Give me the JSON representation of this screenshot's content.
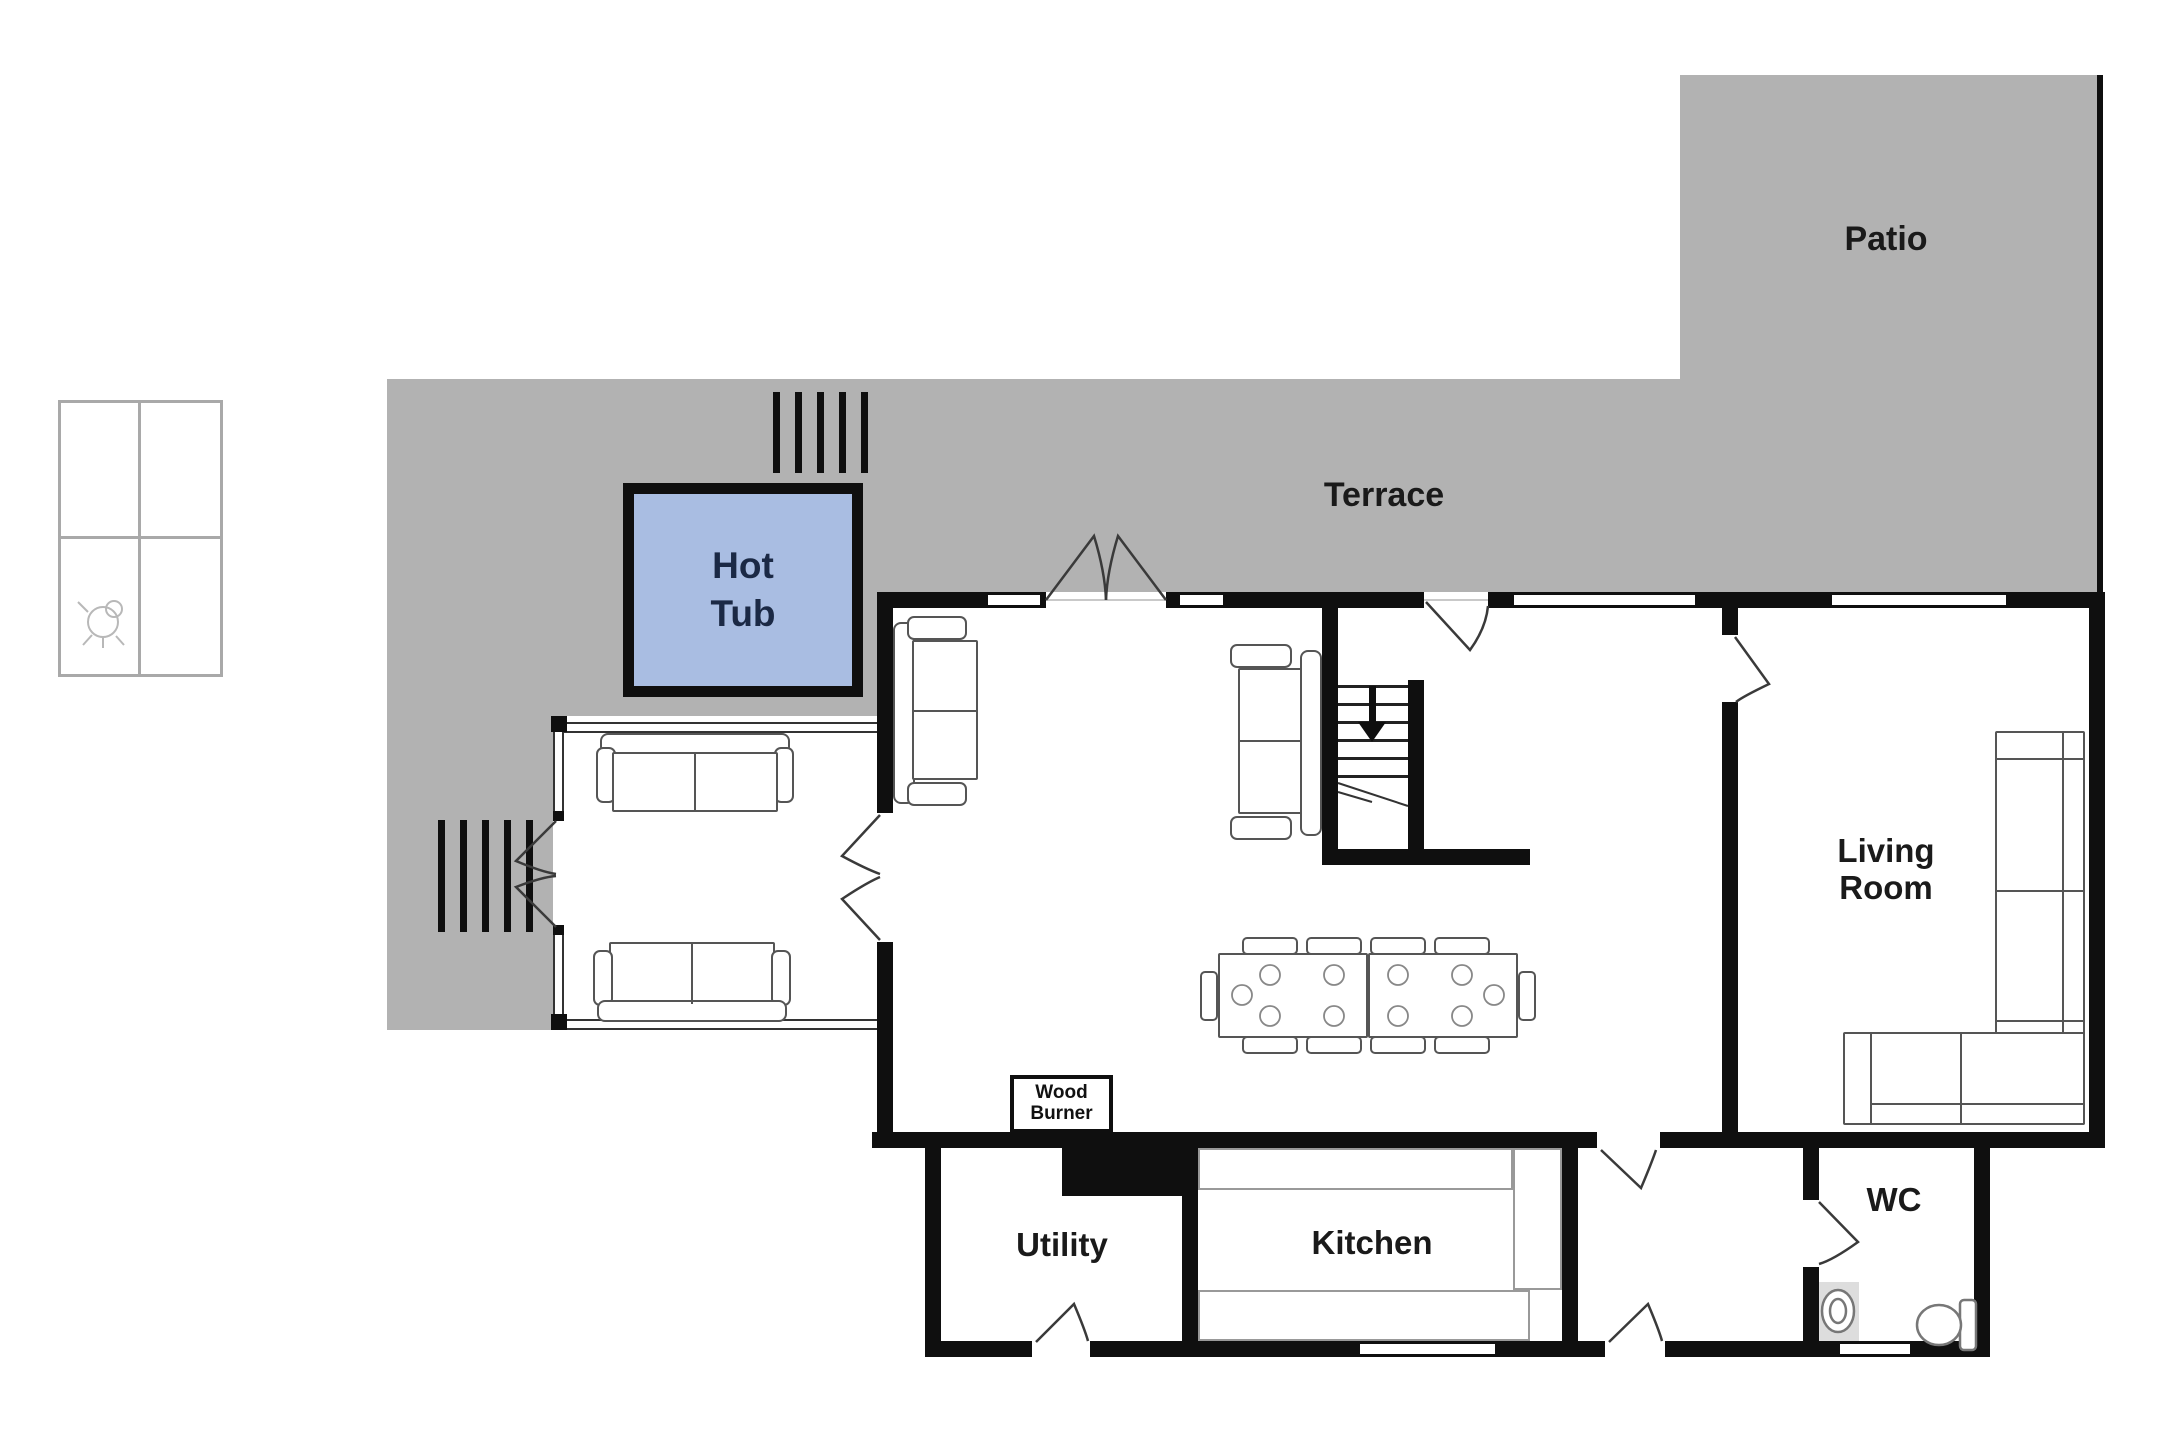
{
  "plan": {
    "areas": {
      "patio_label": "Patio",
      "terrace_label": "Terrace"
    },
    "rooms": {
      "living_room_label": "Living Room",
      "kitchen_label": "Kitchen",
      "utility_label": "Utility",
      "wc_label": "WC"
    },
    "features": {
      "hot_tub_label": "Hot Tub",
      "wood_burner_label": "Wood Burner",
      "stairs_direction": "down"
    },
    "icons": {
      "stairs_arrow": "down-arrow-icon",
      "legend_symbol": "window-pane-legend-icon",
      "toilet": "toilet-icon",
      "sink": "sink-icon"
    },
    "colors": {
      "terrace_gray": "#b2b2b2",
      "wall_black": "#0f0f0f",
      "hot_tub_fill": "#a9bde2",
      "hot_tub_text": "#1b2945",
      "furniture_outline": "#555555",
      "counter_outline": "#999999",
      "label_text": "#1a1a1a"
    }
  }
}
